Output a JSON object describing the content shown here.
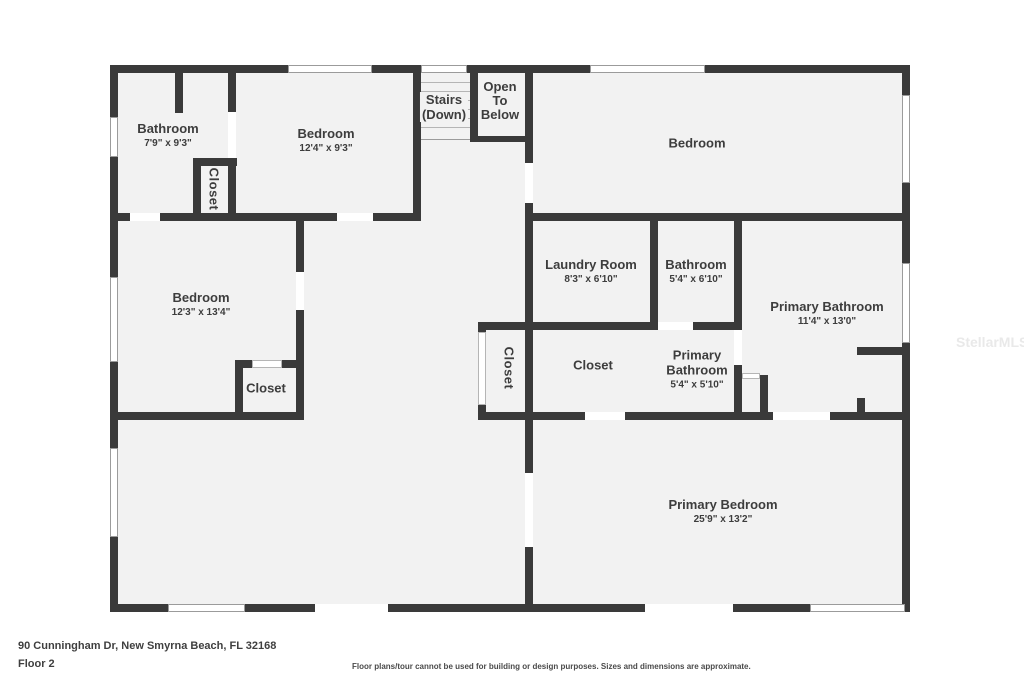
{
  "meta": {
    "address": "90 Cunningham Dr, New Smyrna Beach, FL 32168",
    "floor_label": "Floor 2",
    "disclaimer": "Floor plans/tour cannot be used for building or design purposes. Sizes and dimensions are approximate.",
    "watermark": "StellarMLS"
  },
  "colors": {
    "wall": "#3a3a3a",
    "room_fill": "#f2f2f2",
    "window": "#ffffff",
    "label_text": "#3d3d3d"
  },
  "plan": {
    "bathroom_tl": {
      "name": "Bathroom",
      "dims": "7'9\" x 9'3\""
    },
    "closet_tl": {
      "name": "Closet"
    },
    "bedroom_tl": {
      "name": "Bedroom",
      "dims": "12'4\" x 9'3\""
    },
    "stairs": {
      "line1": "Stairs",
      "line2": "(Down)"
    },
    "open_below": {
      "line1": "Open",
      "line2": "To",
      "line3": "Below"
    },
    "bedroom_tr": {
      "name": "Bedroom"
    },
    "laundry": {
      "name": "Laundry Room",
      "dims": "8'3\" x 6'10\""
    },
    "bathroom_mid": {
      "name": "Bathroom",
      "dims": "5'4\" x 6'10\""
    },
    "primary_bath": {
      "name": "Primary Bathroom",
      "dims": "11'4\" x 13'0\""
    },
    "bedroom_ml": {
      "name": "Bedroom",
      "dims": "12'3\" x 13'4\""
    },
    "closet_ml": {
      "name": "Closet"
    },
    "closet_center_v": {
      "name": "Closet"
    },
    "closet_center": {
      "name": "Closet"
    },
    "primary_bath_small": {
      "name_line1": "Primary",
      "name_line2": "Bathroom",
      "dims": "5'4\" x 5'10\""
    },
    "primary_bedroom": {
      "name": "Primary Bedroom",
      "dims": "25'9\" x 13'2\""
    }
  }
}
